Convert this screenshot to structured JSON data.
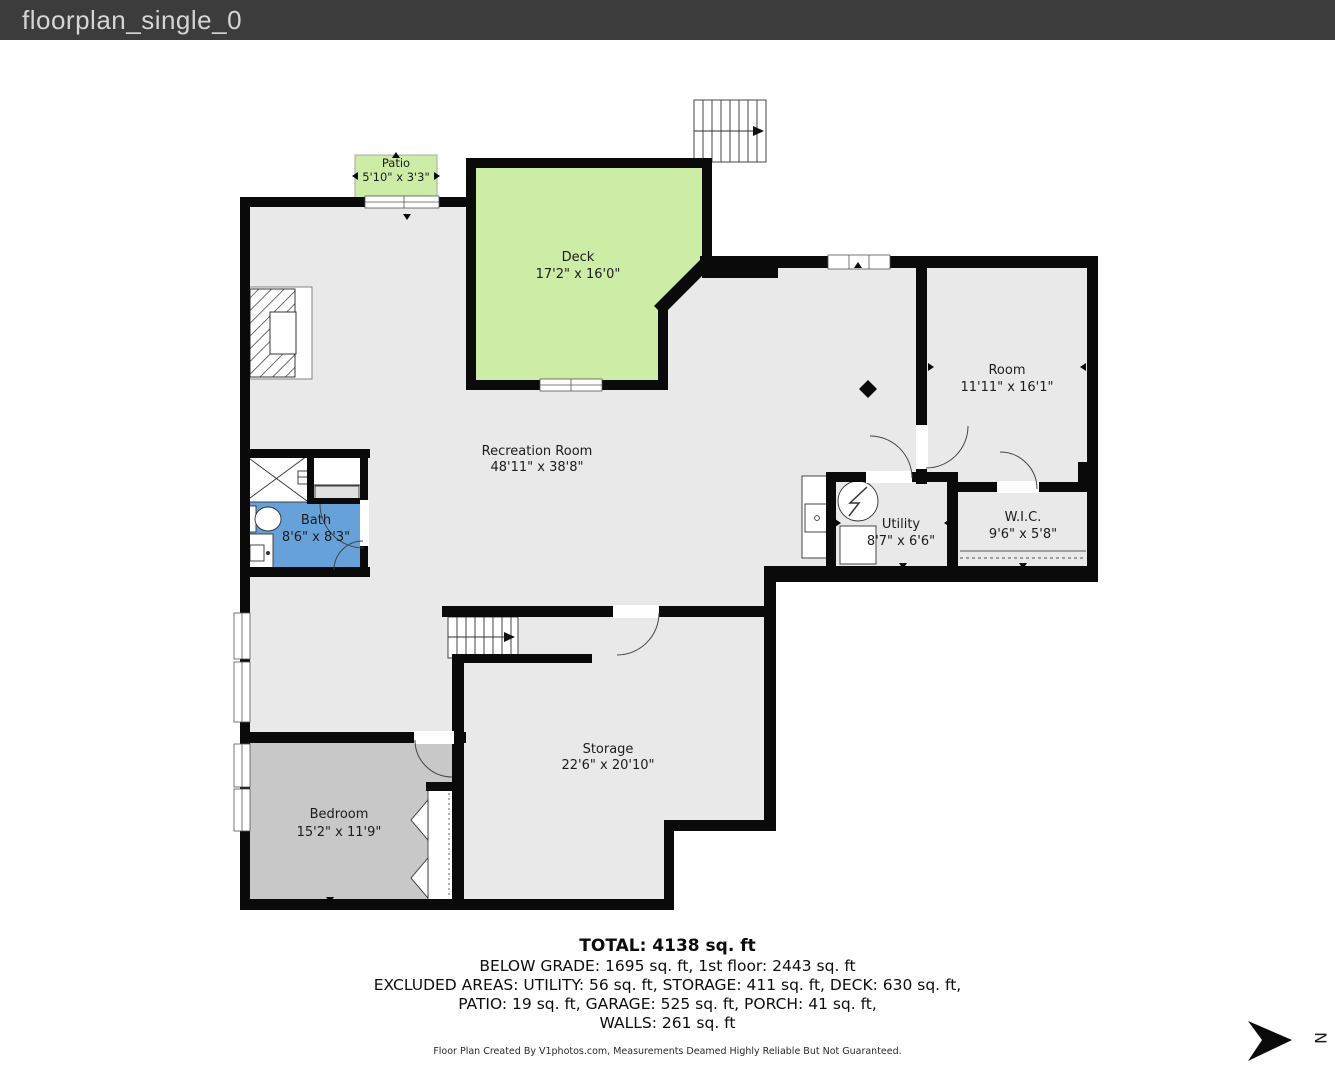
{
  "window": {
    "title": "floorplan_single_0"
  },
  "plan": {
    "rooms": {
      "patio": {
        "name": "Patio",
        "dims": "5'10\" x 3'3\""
      },
      "deck": {
        "name": "Deck",
        "dims": "17'2\" x 16'0\""
      },
      "recreation": {
        "name": "Recreation Room",
        "dims": "48'11\" x 38'8\""
      },
      "room": {
        "name": "Room",
        "dims": "11'11\" x 16'1\""
      },
      "bath": {
        "name": "Bath",
        "dims": "8'6\" x 8'3\""
      },
      "utility": {
        "name": "Utility",
        "dims": "8'7\" x 6'6\""
      },
      "wic": {
        "name": "W.I.C.",
        "dims": "9'6\" x 5'8\""
      },
      "bedroom": {
        "name": "Bedroom",
        "dims": "15'2\" x 11'9\""
      },
      "storage": {
        "name": "Storage",
        "dims": "22'6\" x 20'10\""
      }
    }
  },
  "summary": {
    "total": "TOTAL: 4138 sq. ft",
    "grade_line": "BELOW GRADE: 1695 sq. ft, 1st floor: 2443 sq. ft",
    "excluded_line_1": "EXCLUDED AREAS: UTILITY: 56 sq. ft, STORAGE: 411 sq. ft, DECK: 630 sq. ft,",
    "excluded_line_2": "PATIO: 19 sq. ft, GARAGE: 525 sq. ft, PORCH: 41 sq. ft,",
    "walls_line": "WALLS: 261 sq. ft"
  },
  "footer": {
    "credit": "Floor Plan Created By V1photos.com, Measurements Deamed Highly Reliable But Not Guaranteed."
  },
  "compass": {
    "letter": "N"
  },
  "colors": {
    "titlebar_bg": "#3c3c3c",
    "deck_green": "#cdeca5",
    "bath_blue": "#66a1d9",
    "floor_gray": "#e9e9e9",
    "bedroom_gray": "#c8c8c8",
    "wall_black": "#0a0a0a"
  }
}
